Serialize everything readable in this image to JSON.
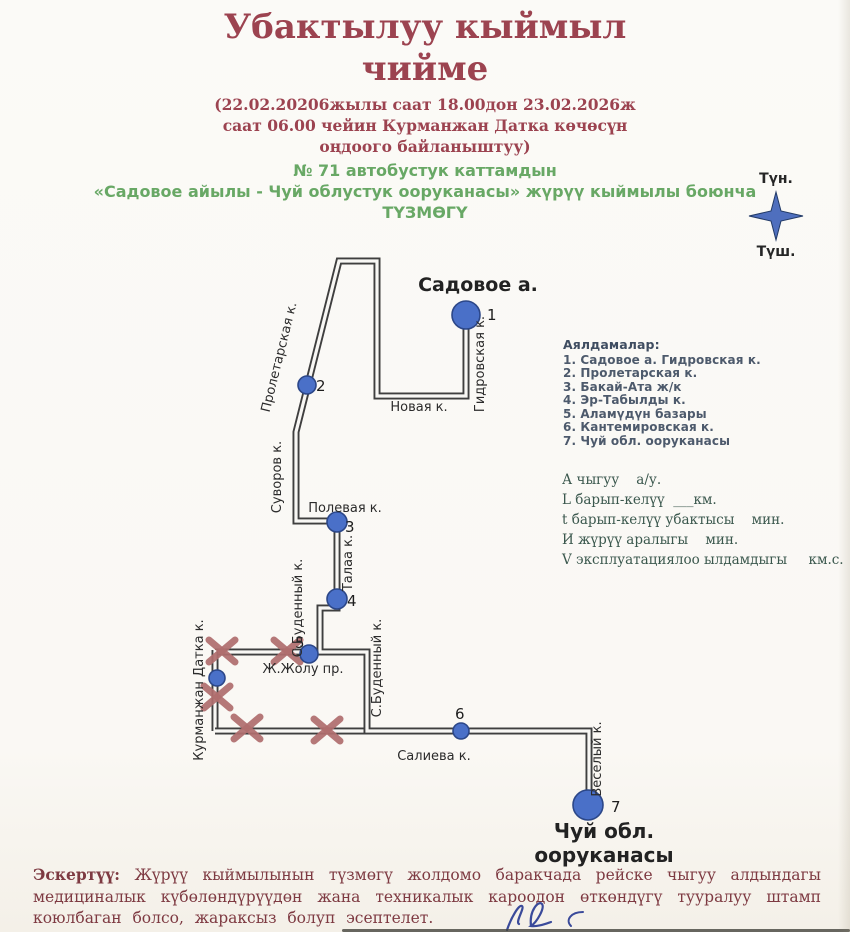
{
  "header": {
    "title_line1": "Убактылуу кыймыл",
    "title_line2": "чийме",
    "subtitle_lines": [
      "(22.02.20206жылы саат 18.00дон 23.02.2026ж",
      "саат 06.00 чейин Курманжан Датка көчөсүн",
      "оңдоого байланыштуу)"
    ],
    "green_lines": [
      "№ 71  автобустук каттамдын",
      "«Садовое айылы  - Чуй облустук ооруканасы» жүрүү кыймылы боюнча",
      "ТҮЗМӨГҮ"
    ]
  },
  "compass": {
    "north": "Түн.",
    "south": "Түш."
  },
  "legend": {
    "title": "Аялдамалар:",
    "items": [
      "1. Садовое а. Гидровская к.",
      "2. Пролетарская к.",
      "3. Бакай-Ата ж/к",
      "4. Эр-Табылды к.",
      "5. Аламүдүн базары",
      "6. Кантемировская к.",
      "7. Чуй обл. ооруканасы"
    ]
  },
  "variables": {
    "lines": [
      "А чыгуу    а/у.",
      "L барып-келүү  ___км.",
      "t барып-келүү убактысы    мин.",
      "И жүрүү аралыгы    мин.",
      "V эксплуатациялоо ылдамдыгы     км.с."
    ]
  },
  "note": {
    "label": "Эскертүү:",
    "body": " Жүрүү кыймылынын түзмөгү жолдомо баракчада рейске чыгуу алдындагы медициналык күбөлөндүрүүдөн жана техникалык кароодон өткөндүгү тууралуу штамп коюлбаган болсо, жараксыз болуп эсептелет."
  },
  "colors": {
    "title": "#9c4350",
    "green": "#68a865",
    "legend": "#3f4d61",
    "vars": "#3b584e",
    "note": "#7e3a42",
    "street": "#3f3f3f",
    "street_inner": "#f8f7f4",
    "stop_fill": "#4a70c8",
    "stop_stroke": "#2c4788",
    "closure": "#b06e6e",
    "compass": "#4f6fbe",
    "compass_edge": "#223a66",
    "label": "#2b2b2b",
    "signature": "#3a4a9a"
  },
  "map": {
    "streets": [
      {
        "closed": true,
        "points": [
          [
            215,
            652
          ],
          [
            320,
            652
          ]
        ]
      },
      {
        "closed": true,
        "points": [
          [
            215,
            650
          ],
          [
            215,
            731
          ]
        ]
      },
      {
        "closed": true,
        "points": [
          [
            215,
            731
          ],
          [
            367,
            731
          ]
        ]
      },
      {
        "closed": false,
        "points": [
          [
            466,
            318
          ],
          [
            466,
            396
          ],
          [
            377,
            396
          ],
          [
            377,
            261
          ],
          [
            339,
            261
          ],
          [
            296,
            432
          ],
          [
            296,
            521
          ],
          [
            337,
            521
          ],
          [
            337,
            608
          ],
          [
            320,
            608
          ],
          [
            320,
            652
          ],
          [
            367,
            652
          ],
          [
            367,
            731
          ],
          [
            589,
            731
          ],
          [
            589,
            803
          ]
        ]
      }
    ],
    "closures": [
      {
        "x": 222,
        "y": 651
      },
      {
        "x": 287,
        "y": 651
      },
      {
        "x": 217,
        "y": 697
      },
      {
        "x": 247,
        "y": 728
      },
      {
        "x": 327,
        "y": 730
      }
    ],
    "stops": [
      {
        "n": "1",
        "x": 466,
        "y": 315,
        "r": 14,
        "nx": 487,
        "ny": 320
      },
      {
        "n": "2",
        "x": 307,
        "y": 385,
        "r": 9,
        "nx": 316,
        "ny": 391
      },
      {
        "n": "3",
        "x": 337,
        "y": 522,
        "r": 10,
        "nx": 345,
        "ny": 532
      },
      {
        "n": "4",
        "x": 337,
        "y": 599,
        "r": 10,
        "nx": 347,
        "ny": 606
      },
      {
        "n": "5",
        "x": 309,
        "y": 654,
        "r": 9,
        "nx": 295,
        "ny": 648
      },
      {
        "n": "",
        "x": 217,
        "y": 678,
        "r": 8,
        "nx": 0,
        "ny": 0
      },
      {
        "n": "6",
        "x": 461,
        "y": 731,
        "r": 8,
        "nx": 455,
        "ny": 719
      },
      {
        "n": "7",
        "x": 588,
        "y": 805,
        "r": 15,
        "nx": 611,
        "ny": 812
      }
    ],
    "labels": [
      {
        "text": "Садовое а.",
        "x": 478,
        "y": 291,
        "size": 19,
        "bold": true,
        "color": "#222222"
      },
      {
        "text": "Гидровская к.",
        "x": 484,
        "y": 364,
        "rot": -90
      },
      {
        "text": "Новая к.",
        "x": 419,
        "y": 411
      },
      {
        "text": "Пролетарская к.",
        "x": 283,
        "y": 358,
        "rot": -76
      },
      {
        "text": "Суворов к.",
        "x": 281,
        "y": 477,
        "rot": -90
      },
      {
        "text": "Полевая к.",
        "x": 345,
        "y": 512
      },
      {
        "text": "Талаа к.",
        "x": 352,
        "y": 563,
        "rot": -90
      },
      {
        "text": "С.Буденный к.",
        "x": 302,
        "y": 608,
        "rot": -90
      },
      {
        "text": "Ж.Жолу пр.",
        "x": 303,
        "y": 673
      },
      {
        "text": "С.Буденный к.",
        "x": 381,
        "y": 668,
        "rot": -90
      },
      {
        "text": "Курманжан Датка к.",
        "x": 203,
        "y": 690,
        "rot": -90
      },
      {
        "text": "Салиева к.",
        "x": 434,
        "y": 760
      },
      {
        "text": "Веселый к.",
        "x": 601,
        "y": 759,
        "rot": -90
      },
      {
        "text": "Чуй обл.",
        "x": 604,
        "y": 838,
        "size": 20,
        "bold": true,
        "color": "#222222"
      },
      {
        "text": "ооруканасы",
        "x": 604,
        "y": 862,
        "size": 20,
        "bold": true,
        "color": "#222222"
      }
    ]
  }
}
